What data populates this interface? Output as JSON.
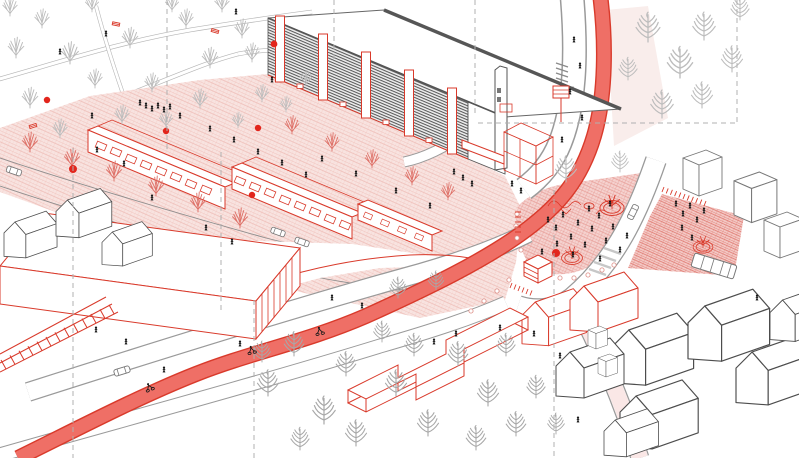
{
  "meta": {
    "description": "Axonometric architectural line-drawing of an urban regeneration masterplan: a large slab building with red stair cores, arcade terraces along a pink pedestrian promenade, a red cycle highway sweeping through a central hatched plaza with kiosk and tree planters, surrounding gabled houses, park with bare trees, and proposed interventions drawn in red over a grey existing city.",
    "canvas": {
      "width": 799,
      "height": 458
    },
    "visible_text": "none"
  },
  "colors": {
    "paper": "#ffffff",
    "accentRed": "#d93a2b",
    "markerRed": "#e2251c",
    "bandFill": "#ef6f66",
    "bandEdge": "#d93a2b",
    "pinkLight": "#f8e3e0",
    "pinkLine": "#eebcb6",
    "pinkStrong": "#f5d2cf",
    "pinkStrongLine": "#e79d96",
    "redHatchBase": "#f3c8c4",
    "redHatchLine": "#dd7168",
    "inkDark": "#4d4d4d",
    "inkBlack": "#1a1a1a",
    "grayLine": "#8c8c8c",
    "roadLine": "#9a9a9a",
    "pathGray": "#b5b5b5",
    "treeGray": "#bdbdbd",
    "treeGraySoft": "#a8a8a8",
    "treeRed": "#de7168",
    "dashGray": "#b0b0b0",
    "facadeBase": "#ededed",
    "facadeLine": "#555555",
    "bollardRim": "#dd8d85"
  },
  "scene": {
    "style": "architectural axonometric line drawing, red = proposed intervention",
    "features": [
      {
        "name": "park-with-paths",
        "description": "park with bare winter trees and curving footpaths, top left"
      },
      {
        "name": "slab-building",
        "description": "long existing slab block with striped facade and five red stair cores"
      },
      {
        "name": "chimney-tower",
        "description": "thin chimney tower with red wireframe addition at building end"
      },
      {
        "name": "arcade-terraces",
        "description": "row of low red-outlined pavilions with shopfronts and hatched roofs"
      },
      {
        "name": "pedestrian-promenade",
        "description": "pink cross-hatched shared surface with red street trees"
      },
      {
        "name": "market-hall",
        "description": "large red-outlined hall in left foreground"
      },
      {
        "name": "row-houses-left",
        "description": "existing gabled houses drawn in dark line"
      },
      {
        "name": "cycle-highway",
        "description": "solid red curved cycle route sweeping across the plan"
      },
      {
        "name": "central-plaza",
        "description": "strongly hatched pink square with crowd, planters, playground, kiosk and bollard dots"
      },
      {
        "name": "east-plaza",
        "description": "red hatched secondary square with planter and bus stop"
      },
      {
        "name": "street-network",
        "description": "white roads with grey kerbs, zebra crossings and cars"
      },
      {
        "name": "gabled-houses-right",
        "description": "white existing housing blocks bottom right"
      },
      {
        "name": "red-proposed-houses",
        "description": "red wireframe gabled infill houses"
      },
      {
        "name": "angular-pavilion",
        "description": "zig-zag single storey red wireframe building among trees"
      },
      {
        "name": "pergola-colonnade",
        "description": "red ladder-like pergola structure bottom left"
      },
      {
        "name": "survey-lines",
        "description": "grey dashed section/grid lines over the drawing"
      },
      {
        "name": "pedestrians",
        "description": "small black figures across plaza and promenade"
      },
      {
        "name": "cyclists",
        "description": "black cyclists on the red cycle highway"
      },
      {
        "name": "marker-dots",
        "description": "solid red point markers at intervention spots"
      }
    ]
  }
}
